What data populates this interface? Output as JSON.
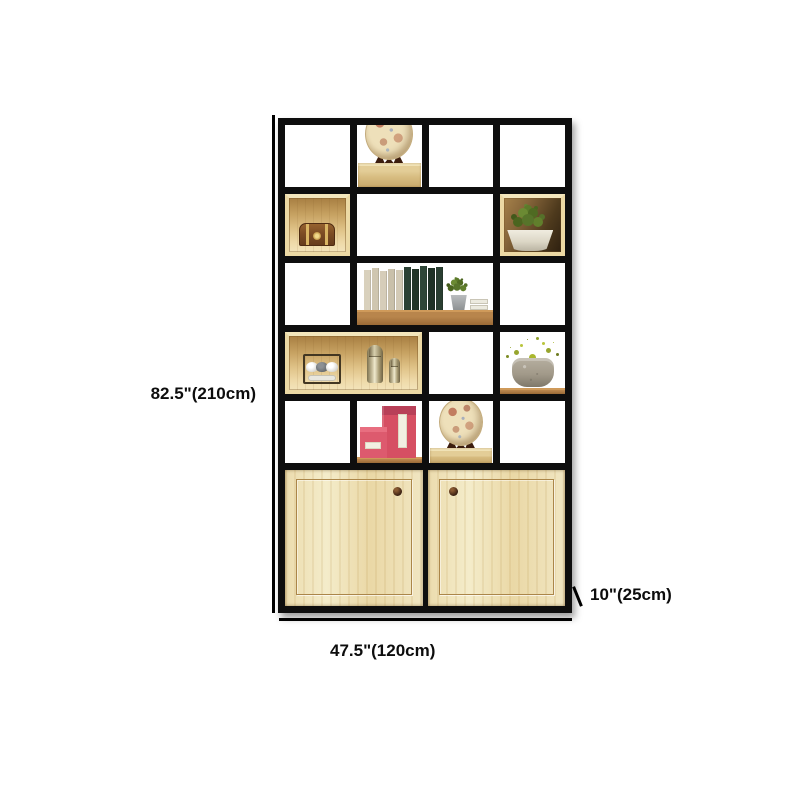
{
  "image": {
    "description": "Product dimension photo of a black metal frame display bookshelf with wood boxes, decor items and two pine cabinet doors",
    "background_color": "#ffffff"
  },
  "dimensions": {
    "height_label": "82.5\"(210cm)",
    "width_label": "47.5\"(120cm)",
    "depth_label": "10\"(25cm)"
  },
  "palette": {
    "frame": "#0e0e0e",
    "annotation_text": "#0d0d0d",
    "light_wood": "#e9d6a2",
    "gold_box_interior": "#d9ba7c",
    "plank_wood": "#a9763f",
    "door_wood": "#f1e5c0",
    "groove": "#ab8649",
    "knob": "#3a2012",
    "pink_box": "#d64f63",
    "foliage_green": "#5c7a2a",
    "berry_green": "#aab72e",
    "stone_pot": "#a29a8a",
    "white_pot": "#e6e2d4",
    "plate": "#e3d1a6"
  },
  "shelf": {
    "grid": "4 columns x 5 display rows + cabinet base",
    "items": [
      {
        "name": "decorative-plate-on-stand",
        "location": "row 1, column 2"
      },
      {
        "name": "wooden-chest-in-gold-box",
        "location": "row 2, column 1"
      },
      {
        "name": "green-plant-in-white-bowl-box",
        "location": "row 2, column 4"
      },
      {
        "name": "books-plant-on-plank",
        "location": "row 3, columns 2-3"
      },
      {
        "name": "cup-rack-and-shakers-box",
        "location": "row 4, columns 1-2"
      },
      {
        "name": "berry-plant-in-stone-pot",
        "location": "row 4, column 4"
      },
      {
        "name": "pink-gift-boxes",
        "location": "row 5, column 2"
      },
      {
        "name": "decorative-plate-on-stand",
        "location": "row 5, column 3"
      },
      {
        "name": "two-pine-cabinet-doors",
        "location": "bottom"
      }
    ]
  }
}
